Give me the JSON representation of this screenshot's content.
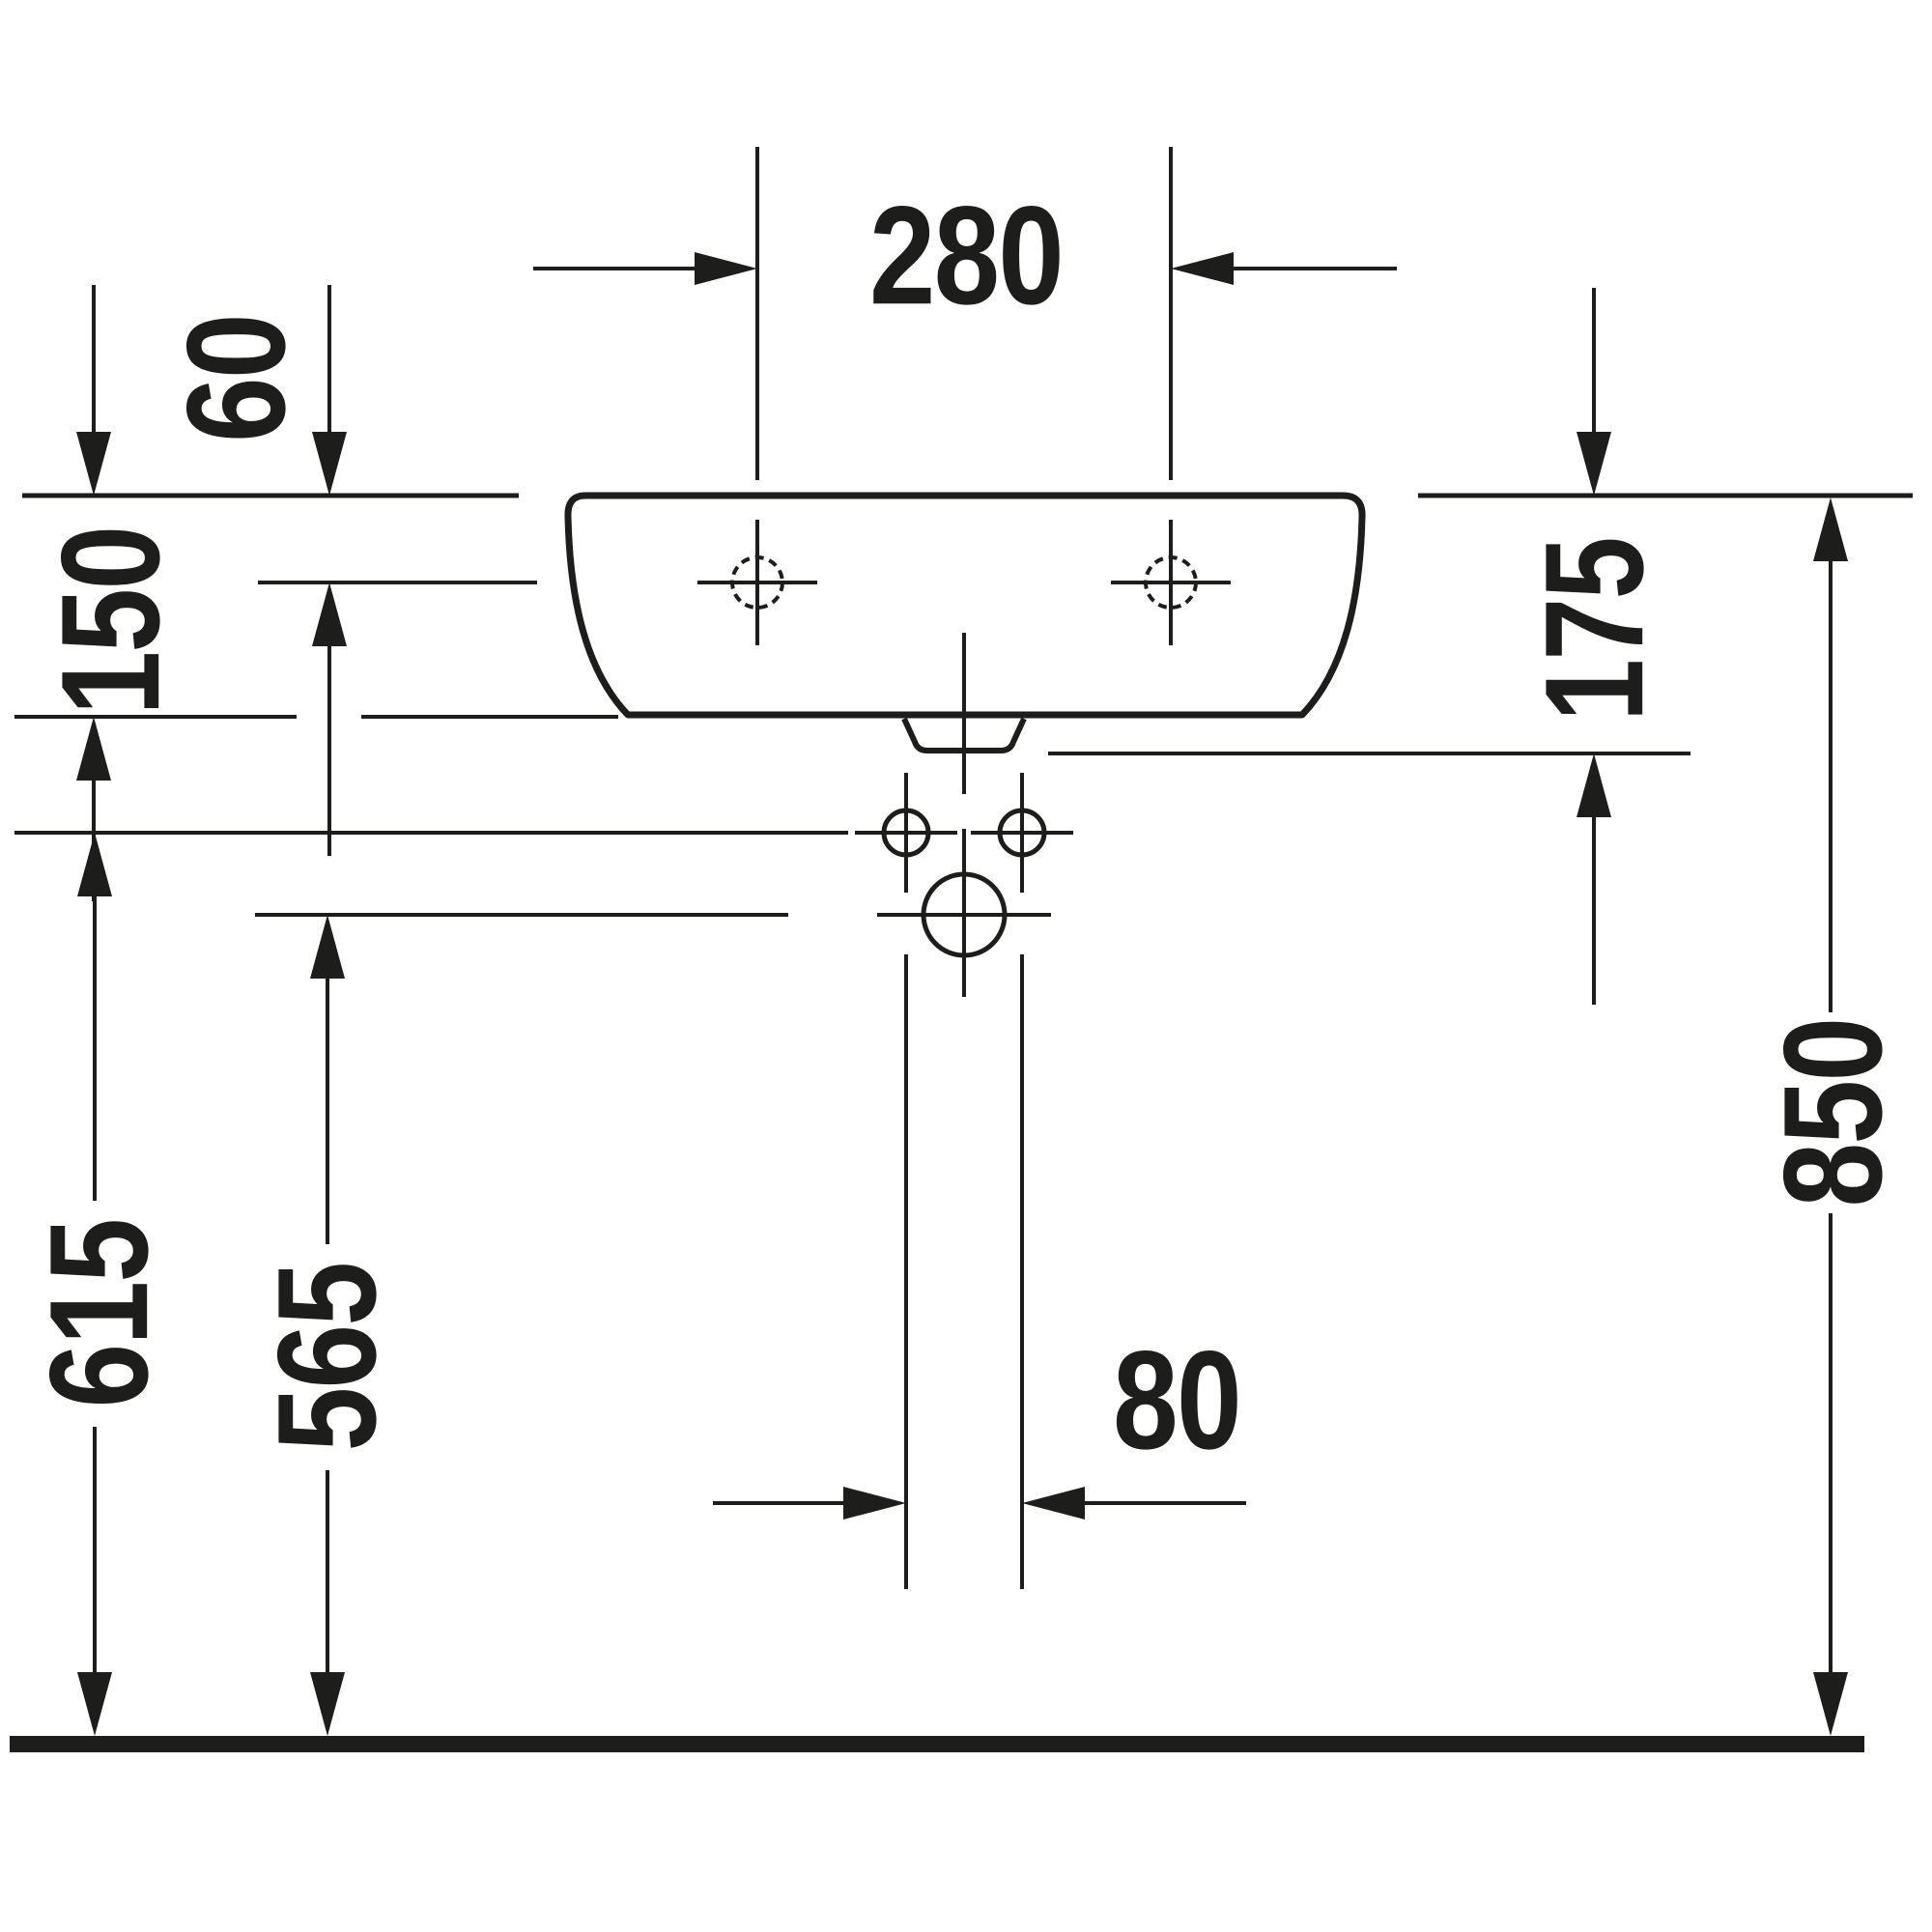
{
  "diagram": {
    "type": "technical-drawing",
    "subject": "wall-mounted washbasin, front elevation with installation dimensions",
    "unit": "mm",
    "colors": {
      "ink": "#1d1d1b",
      "background": "#ffffff"
    },
    "labels": {
      "tap_spacing": "280",
      "rim_to_tap_axis": "60",
      "rim_to_basin_bottom": "150",
      "rim_to_outlet_bottom": "175",
      "floor_to_fixing_holes": "615",
      "floor_to_drain_center": "565",
      "floor_to_rim": "850",
      "pipe_spacing": "80"
    }
  }
}
